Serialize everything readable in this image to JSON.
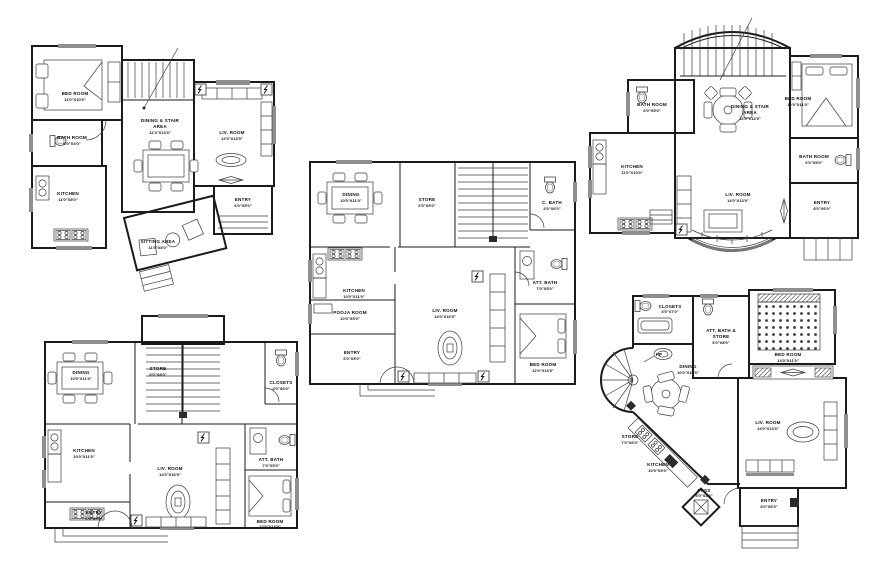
{
  "sheet": {
    "type": "architectural floor plans CAD drawing",
    "plan_count": 5,
    "line_color": "#1b1b1b",
    "window_fill_color": "#8f8f8f",
    "background": "#ffffff"
  },
  "plans": [
    {
      "id": "plan-1",
      "position": "top-left",
      "rooms": [
        {
          "name": "BED ROOM",
          "dims": "11'0\"X10'0\""
        },
        {
          "name": "BATH ROOM",
          "dims": "6'0\"X4'0\""
        },
        {
          "name": "KITCHEN",
          "dims": "11'0\"X8'0\""
        },
        {
          "name": "DINING & STAIR",
          "name2": "AREA",
          "dims": "12'4\"X13'0\""
        },
        {
          "name": "LIV. ROOM",
          "dims": "12'0\"X13'0\""
        },
        {
          "name": "SITTING AREA",
          "dims": "11'0\"X8'0\""
        },
        {
          "name": "ENTRY",
          "dims": "6'0\"X5'0\""
        }
      ]
    },
    {
      "id": "plan-2",
      "position": "center",
      "rooms": [
        {
          "name": "DINING",
          "dims": "10'0\"X11'0\""
        },
        {
          "name": "STORE",
          "dims": "6'0\"X9'0\""
        },
        {
          "name": "C. BATH",
          "dims": "4'0\"X6'0\""
        },
        {
          "name": "KITCHEN",
          "dims": "10'0\"X11'0\""
        },
        {
          "name": "POOJA ROOM",
          "dims": "10'0\"X5'0\""
        },
        {
          "name": "ENTRY",
          "dims": "6'0\"X5'0\""
        },
        {
          "name": "LIV. ROOM",
          "dims": "14'0\"X16'0\""
        },
        {
          "name": "ATT. BATH",
          "dims": "7'0\"X5'0\""
        },
        {
          "name": "BED ROOM",
          "dims": "12'0\"X13'0\""
        }
      ]
    },
    {
      "id": "plan-3",
      "position": "top-right",
      "rooms": [
        {
          "name": "BATH ROOM",
          "dims": "6'0\"X5'0\""
        },
        {
          "name": "DINING & STAIR",
          "name2": "AREA",
          "dims": "12'0\"X13'0\""
        },
        {
          "name": "BED ROOM",
          "dims": "12'0\"X11'0\""
        },
        {
          "name": "KITCHEN",
          "dims": "11'0\"X10'0\""
        },
        {
          "name": "BATH ROOM",
          "dims": "6'0\"X5'0\""
        },
        {
          "name": "LIV. ROOM",
          "dims": "14'0\"X13'0\""
        },
        {
          "name": "ENTRY",
          "dims": "8'0\"X6'0\""
        }
      ]
    },
    {
      "id": "plan-4",
      "position": "bottom-left",
      "rooms": [
        {
          "name": "DINING",
          "dims": "10'0\"X11'0\""
        },
        {
          "name": "STORE",
          "dims": "6'0\"X8'0\""
        },
        {
          "name": "CLOSETS",
          "dims": "4'0\"X6'0\""
        },
        {
          "name": "KITCHEN",
          "dims": "10'0\"X11'0\""
        },
        {
          "name": "ENTRY",
          "dims": "6'0\"X5'0\""
        },
        {
          "name": "LIV. ROOM",
          "dims": "14'0\"X16'0\""
        },
        {
          "name": "ATT. BATH",
          "dims": "7'0\"X5'0\""
        },
        {
          "name": "BED ROOM",
          "dims": "12'0\"X13'0\""
        }
      ]
    },
    {
      "id": "plan-5",
      "position": "bottom-right",
      "rooms": [
        {
          "name": "CLOSETS",
          "dims": "4'0\"X7'0\""
        },
        {
          "name": "ATT. BATH &",
          "name2": "STORE",
          "dims": "6'0\"X8'0\""
        },
        {
          "name": "BED ROOM",
          "dims": "14'0\"X11'0\""
        },
        {
          "name": "DINING",
          "dims": "10'0\"X10'0\""
        },
        {
          "name": "STORE",
          "dims": "7'0\"X6'0\""
        },
        {
          "name": "KITCHEN",
          "dims": "10'0\"X9'0\""
        },
        {
          "name": "LIV. ROOM",
          "dims": "14'0\"X13'0\""
        },
        {
          "name": "PASS",
          "dims": "4'0\"X4'0\""
        },
        {
          "name": "ENTRY",
          "dims": "8'0\"X6'0\""
        },
        {
          "name": "PP",
          "dims": ""
        }
      ]
    }
  ]
}
